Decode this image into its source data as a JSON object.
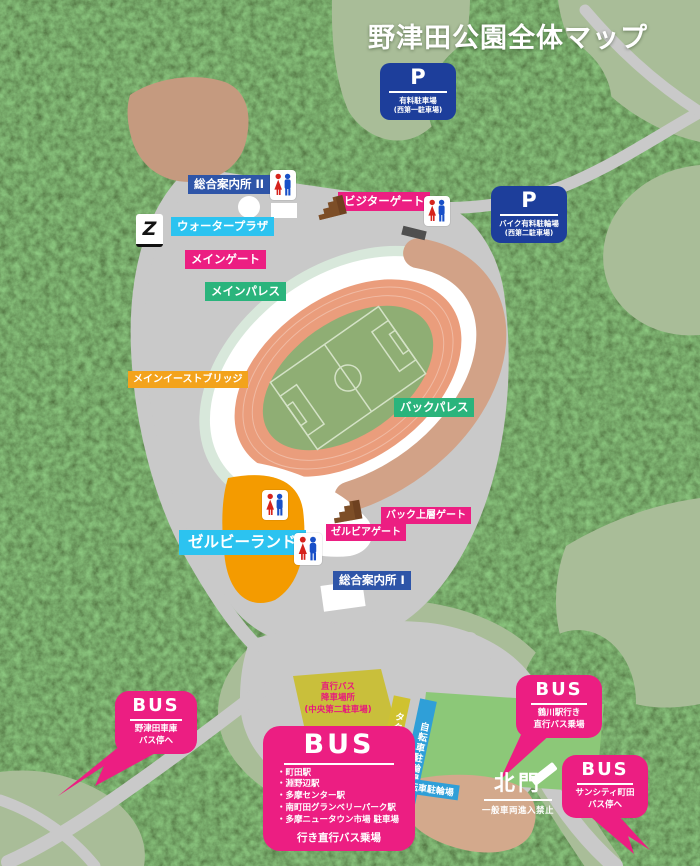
{
  "title": "野津田公園全体マップ",
  "parking": {
    "p1": {
      "symbol": "P",
      "name": "有料駐車場",
      "sub": "(西第一駐車場)"
    },
    "p2": {
      "symbol": "P",
      "name": "バイク有料駐輪場",
      "sub": "(西第二駐車場)"
    }
  },
  "facility_labels": {
    "info_center_2": "総合案内所 II",
    "water_plaza": "ウォータープラザ",
    "main_gate": "メインゲート",
    "main_palace": "メインパレス",
    "visitor_gate": "ビジターゲート",
    "main_east_bridge": "メインイーストブリッジ",
    "back_palace": "バックパレス",
    "back_upper_gate": "バック上層ゲート",
    "zelvia_gate": "ゼルビアゲート",
    "zelvy_land": "ゼルビーランド",
    "info_center_1": "総合案内所 I"
  },
  "ground_labels": {
    "dropoff_line1": "直行バス",
    "dropoff_line2": "降車場所",
    "dropoff_line3": "(中央第二駐車場)",
    "taxi_stand": "タクシー乗降場",
    "bicycle_parking_side": "自転車駐輪場",
    "bicycle_parking_bottom": "自転車駐輪場"
  },
  "north_gate": {
    "label": "北門",
    "note": "一般車両進入禁止"
  },
  "bus": {
    "depot": {
      "heading": "BUS",
      "line1": "野津田車庫",
      "line2": "バス停へ"
    },
    "tsurukawa": {
      "heading": "BUS",
      "line1": "鶴川駅行き",
      "line2": "直行バス乗場"
    },
    "suncity": {
      "heading": "BUS",
      "line1": "サンシティ町田",
      "line2": "バス停へ"
    },
    "terminal": {
      "heading": "BUS",
      "destinations": [
        "・町田駅",
        "・淵野辺駅",
        "・多摩センター駅",
        "・南町田グランベリーパーク駅",
        "・多摩ニュータウン市場 駐車場"
      ],
      "footer": "行き直行バス乗場"
    }
  },
  "icons": {
    "club_logo_glyph": "Z"
  },
  "colors": {
    "label_pink": "#ec1e82",
    "label_blue": "#2e55a8",
    "label_cyan": "#2cc3f0",
    "label_green": "#2ab47c",
    "label_orange": "#f3a31c",
    "parking_blue": "#1d3e9b",
    "zelvy_land_area": "#f49b00",
    "dropoff_yellow": "#c9bf3b",
    "taxi_yellow": "#cfc230",
    "bicycle_blue": "#2f9fd8",
    "field_green": "#8cc878",
    "track_salmon": "#ea9d7c",
    "forest_dark": "#3c5a28",
    "open_green": "#a9bd98",
    "road_gray": "#c9c9c9"
  }
}
